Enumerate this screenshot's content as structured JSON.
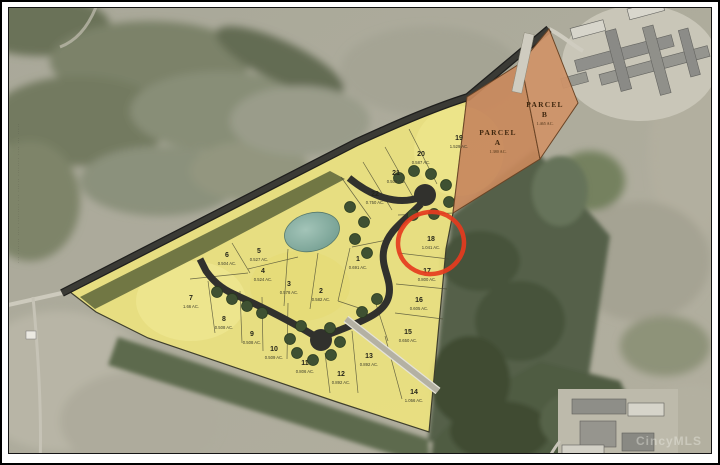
{
  "map": {
    "watermark": "CincyMLS",
    "left_edge_microtext_illegible": "··· ······· ···· ········· ··· ······ ········ ···· ··· ·····",
    "highlighted_lot": "18",
    "highlight_color": "#e63b1e",
    "lot_fill": "#ece27f",
    "parcel_fill": "#c9895c",
    "lots": [
      {
        "num": "1",
        "acreage": "0.691 AC.",
        "x": 358,
        "y": 260
      },
      {
        "num": "2",
        "acreage": "0.582 AC.",
        "x": 321,
        "y": 292
      },
      {
        "num": "3",
        "acreage": "0.578 AC.",
        "x": 289,
        "y": 285
      },
      {
        "num": "4",
        "acreage": "0.524 AC.",
        "x": 263,
        "y": 272
      },
      {
        "num": "5",
        "acreage": "0.527 AC.",
        "x": 259,
        "y": 252
      },
      {
        "num": "6",
        "acreage": "0.504 AC.",
        "x": 227,
        "y": 256
      },
      {
        "num": "7",
        "acreage": "1.66 AC.",
        "x": 191,
        "y": 299
      },
      {
        "num": "8",
        "acreage": "0.508 AC.",
        "x": 224,
        "y": 320
      },
      {
        "num": "9",
        "acreage": "0.508 AC.",
        "x": 252,
        "y": 335
      },
      {
        "num": "10",
        "acreage": "0.509 AC.",
        "x": 274,
        "y": 350
      },
      {
        "num": "11",
        "acreage": "0.806 AC.",
        "x": 305,
        "y": 364
      },
      {
        "num": "12",
        "acreage": "0.892 AC.",
        "x": 341,
        "y": 375
      },
      {
        "num": "13",
        "acreage": "0.892 AC.",
        "x": 369,
        "y": 357
      },
      {
        "num": "14",
        "acreage": "1.056 AC.",
        "x": 414,
        "y": 393
      },
      {
        "num": "15",
        "acreage": "0.650 AC.",
        "x": 408,
        "y": 333
      },
      {
        "num": "16",
        "acreage": "0.605 AC.",
        "x": 419,
        "y": 301
      },
      {
        "num": "17",
        "acreage": "0.800 AC.",
        "x": 427,
        "y": 272
      },
      {
        "num": "18",
        "acreage": "1.041 AC.",
        "x": 431,
        "y": 240
      },
      {
        "num": "19",
        "acreage": "1.529 AC.",
        "x": 459,
        "y": 139
      },
      {
        "num": "20",
        "acreage": "0.587 AC.",
        "x": 421,
        "y": 155
      },
      {
        "num": "21",
        "acreage": "0.509 AC.",
        "x": 396,
        "y": 174
      },
      {
        "num": "22",
        "acreage": "0.750 AC.",
        "x": 375,
        "y": 195
      }
    ],
    "parcels": [
      {
        "line1": "PARCEL",
        "line2": "A",
        "acreage": "1.380 AC.",
        "x": 498,
        "y": 134
      },
      {
        "line1": "PARCEL",
        "line2": "B",
        "acreage": "1.465 AC.",
        "x": 545,
        "y": 106
      }
    ]
  }
}
